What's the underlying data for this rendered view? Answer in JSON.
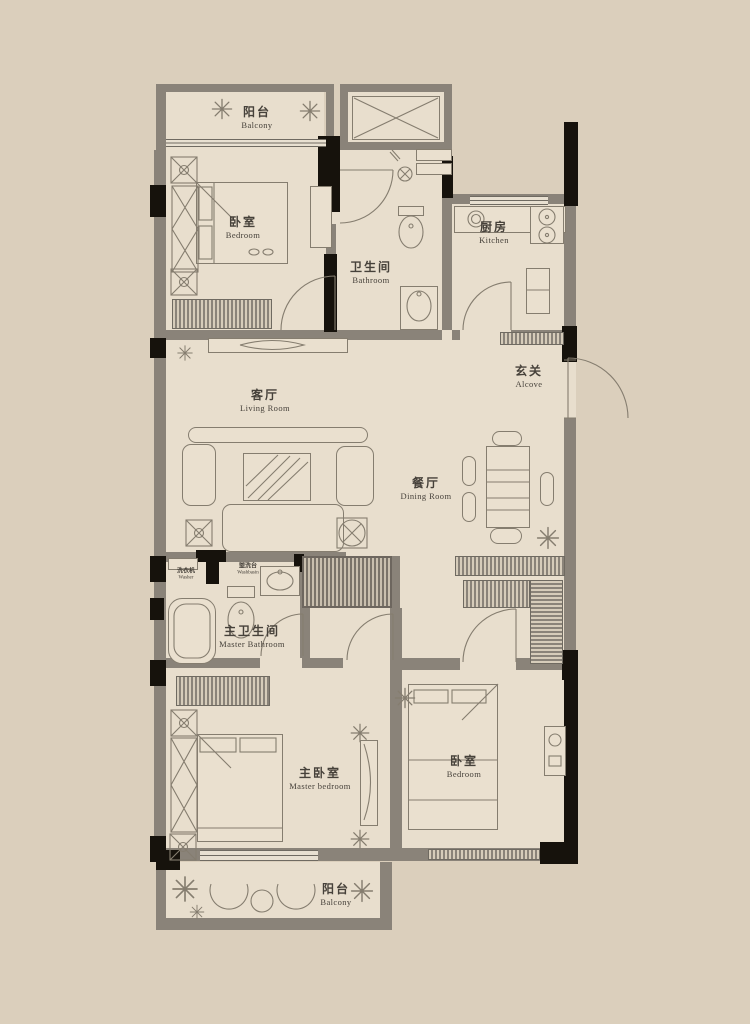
{
  "plan": {
    "type": "residential-floor-plan",
    "colors": {
      "background": "#dbcfbc",
      "floor": "#e8decd",
      "wall_gray": "#8a8379",
      "wall_black": "#16120c",
      "line": "#857d6f",
      "text": "#46413a"
    },
    "rooms": [
      {
        "id": "balcony-top",
        "zh": "阳台",
        "en": "Balcony"
      },
      {
        "id": "bedroom-top",
        "zh": "卧室",
        "en": "Bedroom"
      },
      {
        "id": "bathroom",
        "zh": "卫生间",
        "en": "Bathroom"
      },
      {
        "id": "kitchen",
        "zh": "厨房",
        "en": "Kitchen"
      },
      {
        "id": "living-room",
        "zh": "客厅",
        "en": "Living Room"
      },
      {
        "id": "foyer",
        "zh": "玄关",
        "en": "Alcove"
      },
      {
        "id": "dining-room",
        "zh": "餐厅",
        "en": "Dining Room"
      },
      {
        "id": "master-bathroom",
        "zh": "主卫生间",
        "en": "Master Bathroom"
      },
      {
        "id": "master-bedroom",
        "zh": "主卧室",
        "en": "Master bedroom"
      },
      {
        "id": "bedroom-2",
        "zh": "卧室",
        "en": "Bedroom"
      },
      {
        "id": "balcony-bottom",
        "zh": "阳台",
        "en": "Balcony"
      }
    ],
    "small_labels": [
      {
        "id": "laundry",
        "zh": "洗衣机",
        "en": "Washer"
      },
      {
        "id": "washstand",
        "zh": "盥洗台",
        "en": "Washbasin"
      }
    ],
    "icons": [
      {
        "name": "plant-rosette-icon",
        "shape": "8-petal flower rosette"
      },
      {
        "name": "storage-crate-icon",
        "shape": "square with X and center dot"
      },
      {
        "name": "round-stool-icon",
        "shape": "square with inscribed circle and X"
      },
      {
        "name": "elevator-shaft-icon",
        "shape": "rectangle with diagonal cross"
      }
    ]
  }
}
